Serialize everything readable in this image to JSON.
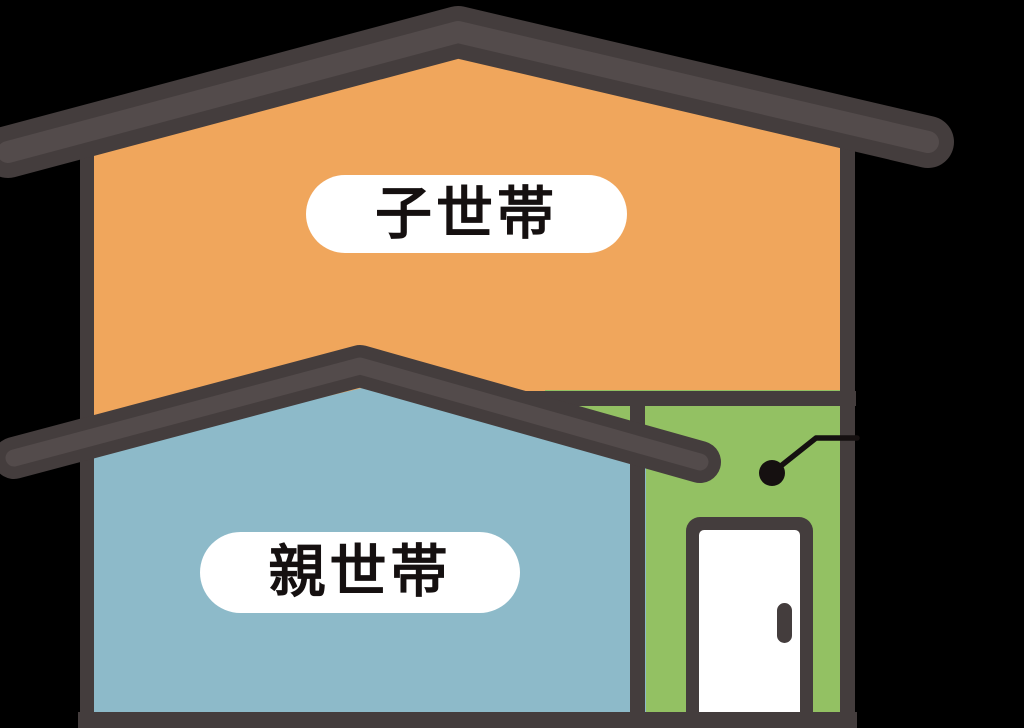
{
  "illustration_type": "two-household-house",
  "house": {
    "upper_floor": {
      "label": "子世帯",
      "wall_color": "#F0A65C"
    },
    "lower_floor": {
      "label": "親世帯",
      "wall_color": "#8DBAC9"
    },
    "entrance": {
      "wall_color": "#93C163",
      "door_color": "#FFFFFF"
    }
  },
  "colors": {
    "bg": "#000000",
    "orange": "#F0A65C",
    "blue": "#8DBAC9",
    "green": "#93C163",
    "dark": "#443D3D",
    "roofstripe": "#534B4B",
    "ink": "#151010",
    "white": "#FFFFFF"
  }
}
